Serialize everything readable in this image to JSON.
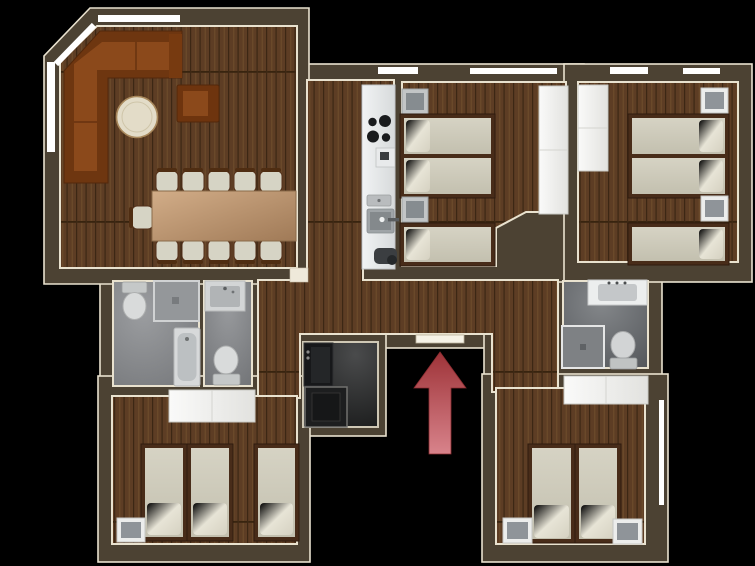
{
  "scene": {
    "type": "apartment-floor-plan",
    "view": "top-down 3d render",
    "background": "#000000",
    "entrance": {
      "indicator": "red-arrow",
      "direction": "up",
      "meaning": "entrance",
      "color_top": "#9e3338",
      "color_bottom": "#d8838b"
    }
  },
  "palette": {
    "wall": "#4c4233",
    "trim_cream": "#e9e2cf",
    "window_white": "#ffffff",
    "wood_base": "#5d3d24",
    "wood_line": "#3c2714",
    "bath_floor_light": "#8e9092",
    "bath_floor_dark": "#5e6164",
    "storage_floor": "#2a2b2c",
    "sofa_orange": "#8b491b",
    "sofa_shadow": "#6e3610",
    "table_tan": "#c2a07c",
    "seat_cream": "#d6d4c5",
    "mattress": "#cfccbb",
    "pillow": "#e9e6da",
    "bed_frame": "#482c19",
    "counter": "#e3e5e6",
    "fixture_light": "#d5d7d8",
    "fixture_mid": "#a7abad",
    "nightstand_frame": "#ecedec",
    "nightstand_top": "#8f9499",
    "wardrobe_white": "#f4f4f2"
  },
  "rooms": [
    {
      "name": "living-dining-room",
      "floor": "wood",
      "furniture": [
        "corner-sofa",
        "armchair",
        "round-table",
        "dining-table",
        "11 chairs"
      ]
    },
    {
      "name": "kitchen",
      "floor": "wood",
      "furniture": [
        "counter",
        "stove-4-burners",
        "coffee-machine",
        "sink",
        "waste-bin"
      ]
    },
    {
      "name": "bedroom-top-middle",
      "floor": "wood",
      "furniture": [
        "twin-double-bed",
        "single-bed",
        "2 nightstands",
        "wardrobe"
      ]
    },
    {
      "name": "bedroom-top-right",
      "floor": "wood",
      "furniture": [
        "twin-double-bed",
        "single-bed",
        "2 nightstands",
        "wardrobe"
      ]
    },
    {
      "name": "bathroom-left",
      "floor": "tile-gray",
      "furniture": [
        "toilet",
        "shower",
        "bathtub"
      ]
    },
    {
      "name": "wc-middle",
      "floor": "tile-gray",
      "furniture": [
        "washbasin",
        "toilet"
      ]
    },
    {
      "name": "bathroom-right",
      "floor": "tile-gray",
      "furniture": [
        "washbasin",
        "shower",
        "toilet"
      ]
    },
    {
      "name": "storage-laundry",
      "floor": "tile-dark",
      "furniture": [
        "washing-machine",
        "shower-tray"
      ]
    },
    {
      "name": "bedroom-bottom-left",
      "floor": "wood",
      "furniture": [
        "3 single beds",
        "nightstand",
        "wardrobe"
      ]
    },
    {
      "name": "bedroom-bottom-right",
      "floor": "wood",
      "furniture": [
        "2 single beds",
        "2 nightstands",
        "wardrobe"
      ]
    },
    {
      "name": "hallway",
      "floor": "wood",
      "furniture": []
    }
  ]
}
